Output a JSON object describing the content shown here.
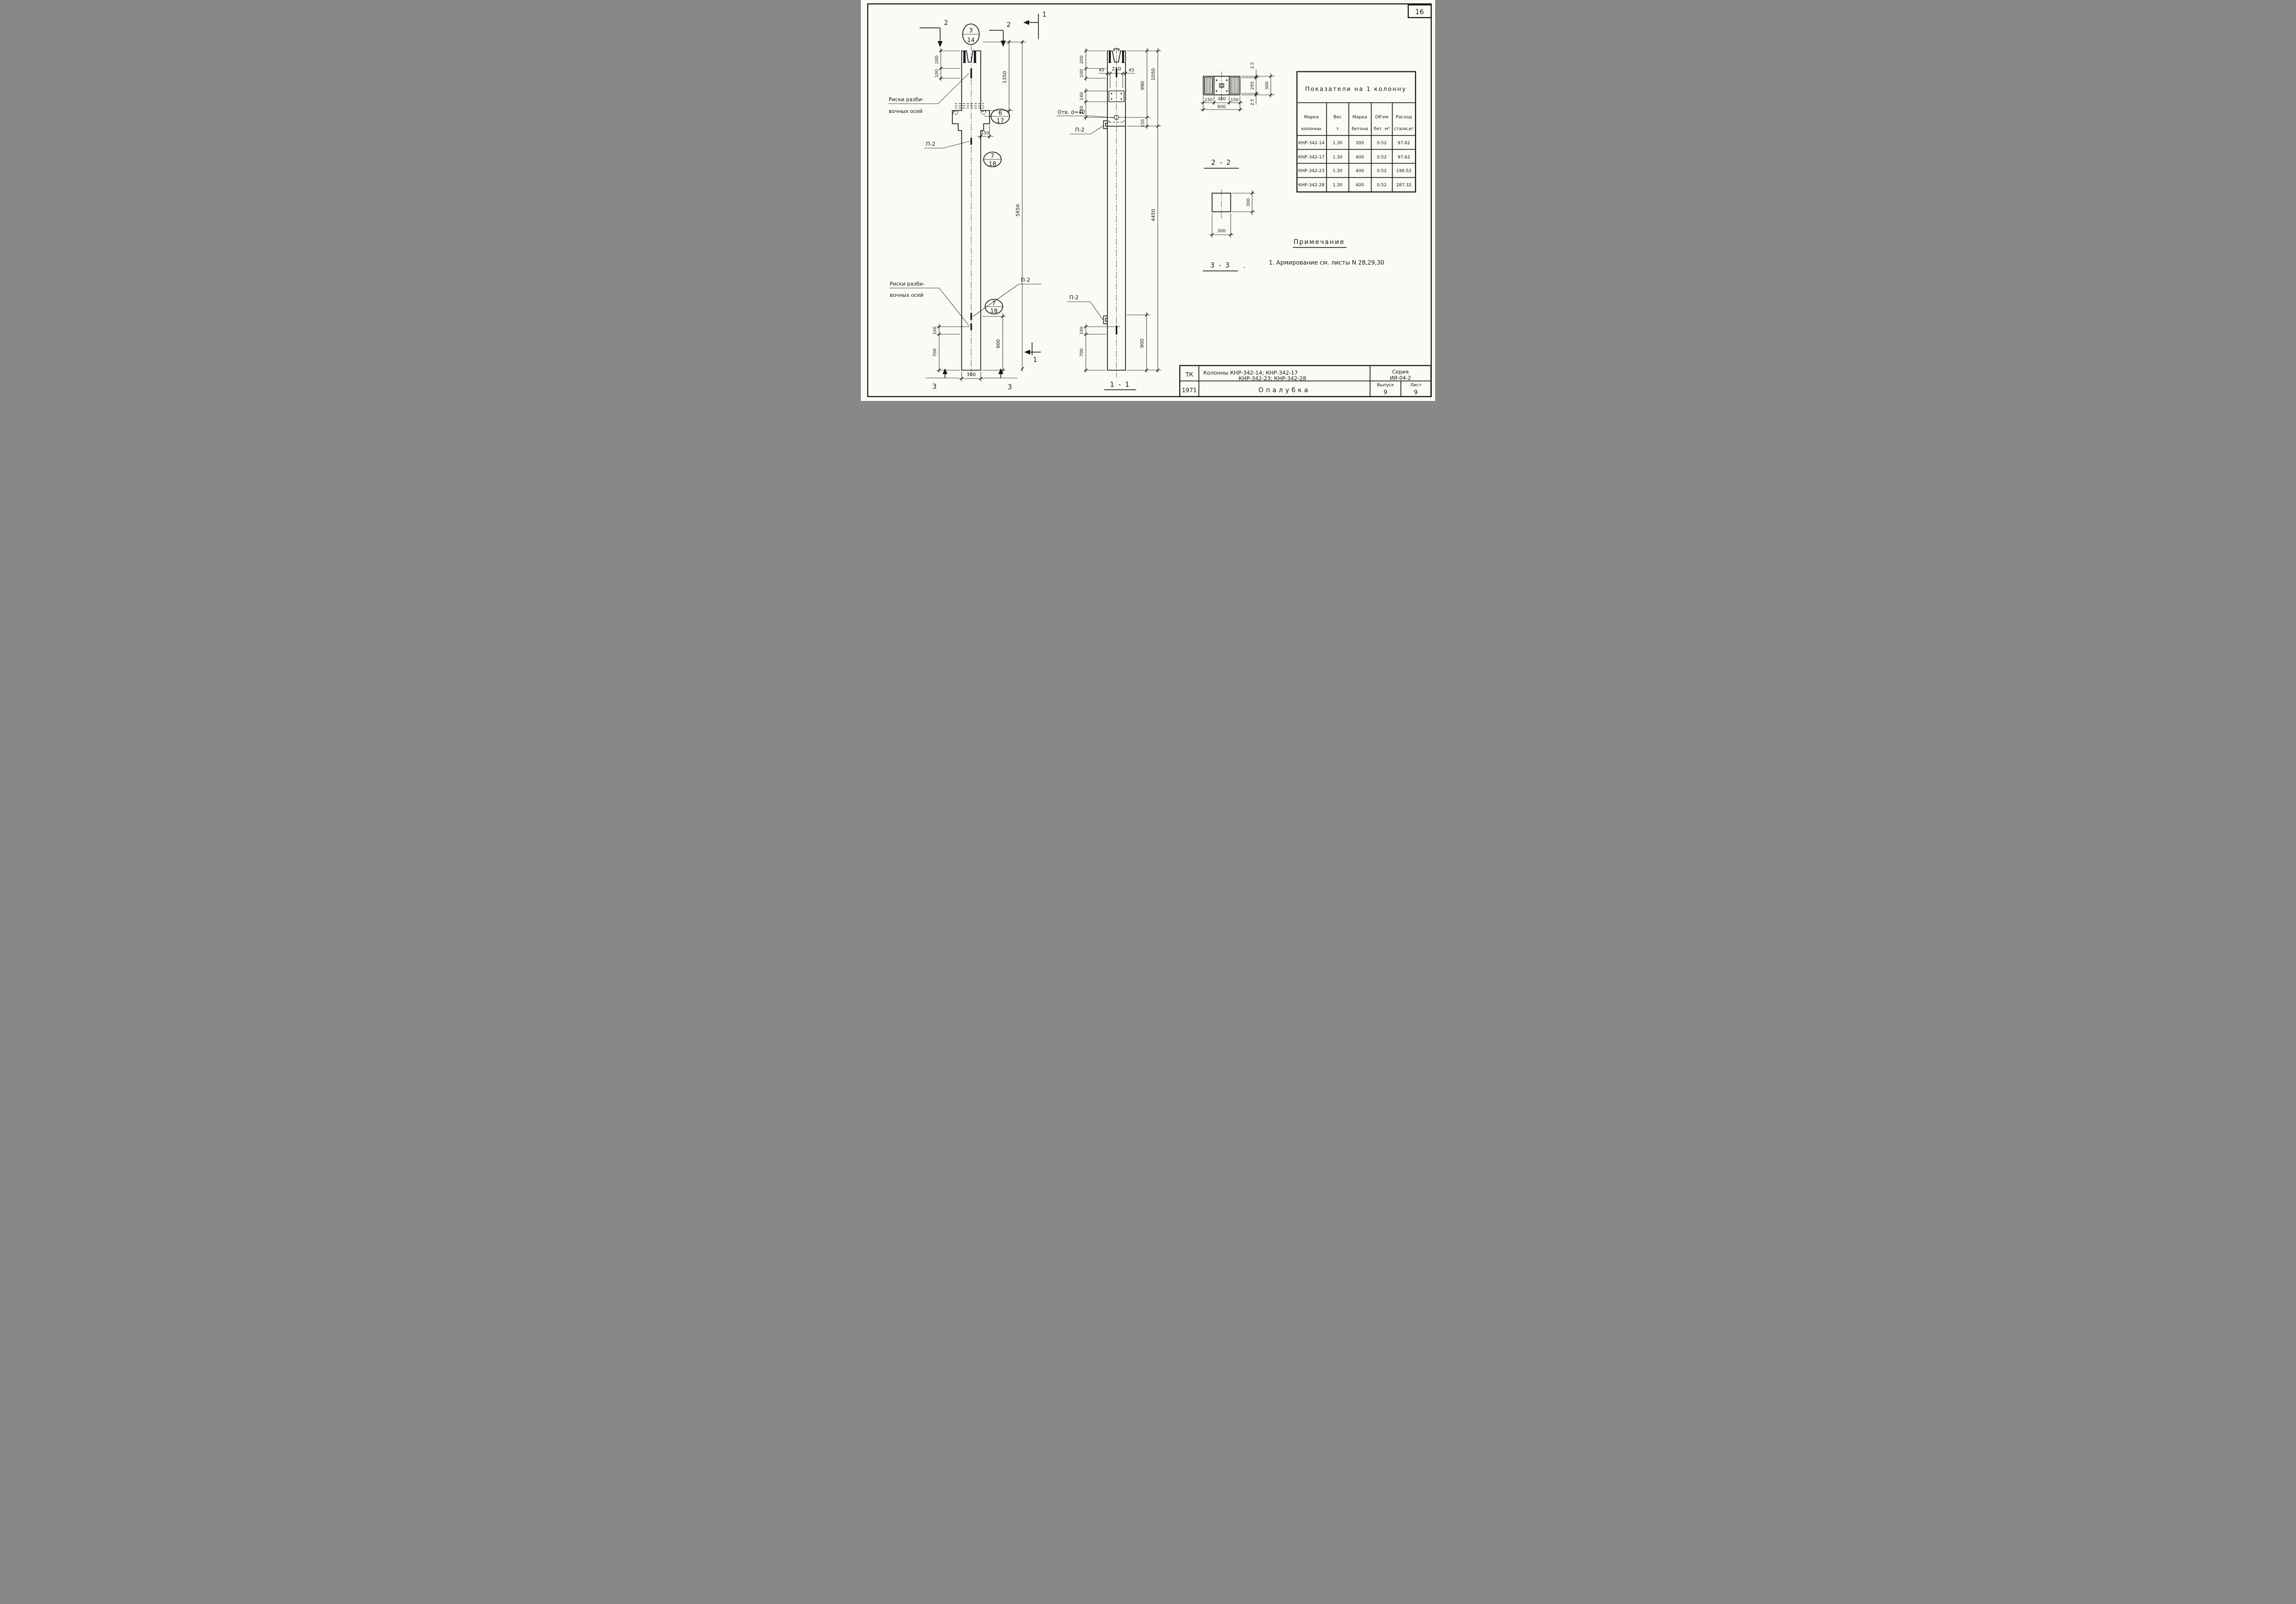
{
  "colors": {
    "paper": "#fbfaf6",
    "ink": "#161616"
  },
  "page": {
    "number": "16"
  },
  "markers": {
    "cut1": "1",
    "cut2": "2",
    "cut3": "3"
  },
  "balloons": {
    "top": {
      "num": "3",
      "den": "14"
    },
    "console": {
      "num": "6",
      "den": "17"
    },
    "shaft": {
      "num": "7",
      "den": "18"
    },
    "bottom": {
      "num": "7",
      "den": "18"
    }
  },
  "left_view": {
    "riski_top_line1": "Риски разби-",
    "riski_top_line2": "вочных осей",
    "riski_bot_line1": "Риски разби-",
    "riski_bot_line2": "вочных осей",
    "p2_upper": "П-2",
    "p2_lower": "П-2",
    "dim_200": "200",
    "dim_100": "100",
    "dim_1350": "1350",
    "dim_5650": "5650",
    "dim_150": "150",
    "dim_100b": "100",
    "dim_700": "700",
    "dim_900": "900",
    "dim_300": "300"
  },
  "middle_view": {
    "title": "1 - 1",
    "otv": "Отв. d=40",
    "p2_upper": "П-2",
    "p2_lower": "П-2",
    "dim_200": "200",
    "dim_100": "100",
    "dim_45l": "45",
    "dim_210": "210",
    "dim_45r": "45",
    "dim_140": "140",
    "dim_230": "230",
    "dim_990": "990",
    "dim_1050": "1050",
    "dim_150": "150",
    "dim_4450": "4450",
    "dim_100b": "100",
    "dim_700": "700",
    "dim_900": "900"
  },
  "section22": {
    "title": "2 - 2",
    "dim_150l": "150",
    "dim_300": "300",
    "dim_150r": "150",
    "dim_600": "600",
    "dim_25t": "2.5",
    "dim_295": "295",
    "dim_25b": "2.5",
    "dim_300v": "300"
  },
  "section33": {
    "title": "3 - 3",
    "period": ".",
    "dim_300v": "300",
    "dim_300h": "300"
  },
  "table": {
    "title": "Показатели на 1 колонну",
    "headers": [
      [
        "Марка",
        "колонны"
      ],
      [
        "Вес",
        "т"
      ],
      [
        "Марка",
        "бетона"
      ],
      [
        "Об'ем",
        "бет. м³"
      ],
      [
        "Расход",
        "стали,кг"
      ]
    ],
    "rows": [
      [
        "КНР-342-14",
        "1.30",
        "300",
        "0.52",
        "97.62"
      ],
      [
        "КНР-342-17",
        "1.30",
        "400",
        "0.52",
        "97.62"
      ],
      [
        "КНР-342-23",
        "1.30",
        "400",
        "0.52",
        "196.52"
      ],
      [
        "КНР-342-28",
        "1.30",
        "400",
        "0.52",
        "287.32"
      ]
    ]
  },
  "notes": {
    "title": "Примечание",
    "item1": "1. Армирование  см. листы  N 28,29,30"
  },
  "title_block": {
    "org": "ТК",
    "year": "1971",
    "subject_line1": "Колонны    КНР-342-14;      КНР-342-17",
    "subject_line2": "КНР-342-23;      КНР-342-28",
    "series_label": "Серия",
    "series_value": "ИИ-04-2",
    "sheet_title": "Опалубка",
    "issue_label": "Выпуск",
    "issue_value": "9",
    "list_label": "Лист",
    "list_value": "9"
  }
}
